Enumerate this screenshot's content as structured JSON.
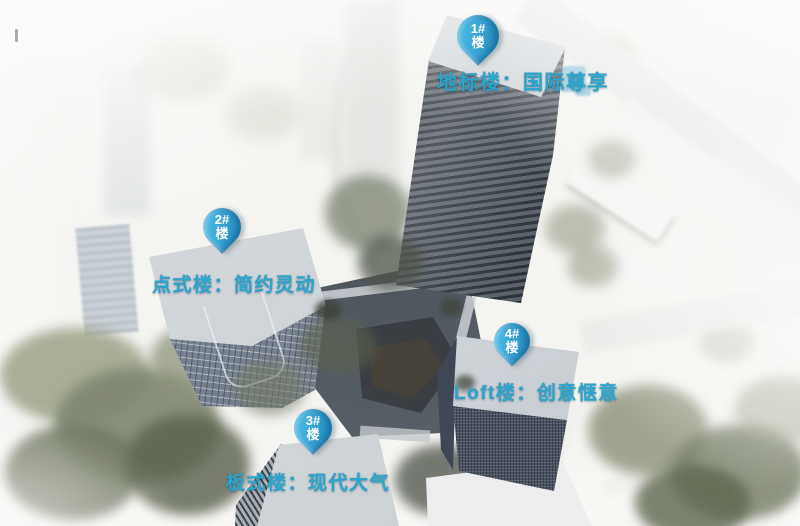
{
  "annotations": {
    "pins": [
      {
        "number": "1#",
        "suffix": "楼"
      },
      {
        "number": "2#",
        "suffix": "楼"
      },
      {
        "number": "3#",
        "suffix": "楼"
      },
      {
        "number": "4#",
        "suffix": "楼"
      }
    ],
    "labels": [
      {
        "text": "地标楼：国际尊享"
      },
      {
        "text": "点式楼：简约灵动"
      },
      {
        "text": "板式楼：现代大气"
      },
      {
        "text": "Loft楼：创意惬意"
      }
    ]
  },
  "colors": {
    "label_text": "#2BA5CB",
    "pin_gradient_top": "#57C4EC",
    "pin_gradient_bottom": "#1C85BB",
    "pin_text": "#FFFFFF"
  }
}
